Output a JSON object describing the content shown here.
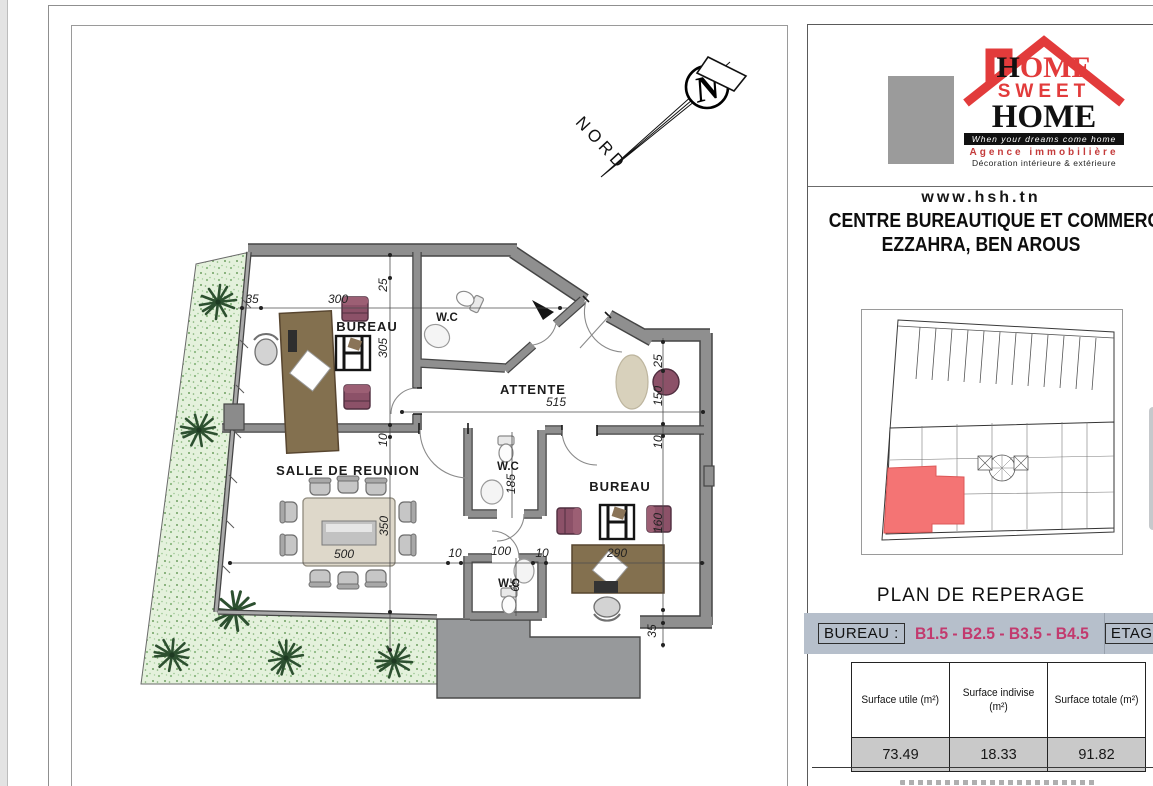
{
  "floor_plan": {
    "north_label": "NORD",
    "room_labels": [
      "BUREAU",
      "W.C",
      "ATTENTE",
      "SALLE DE REUNION",
      "W.C",
      "BUREAU",
      "W.C"
    ],
    "dims": [
      "35",
      "300",
      "25",
      "305",
      "10",
      "350",
      "500",
      "10",
      "100",
      "10",
      "515",
      "25",
      "150",
      "10",
      "160",
      "290",
      "185",
      "65",
      "35"
    ]
  },
  "panel": {
    "brand": {
      "word1": "HOME",
      "word2": "SWEET",
      "word3": "HOME",
      "tagline": "When your dreams come home",
      "agency_line1": "Agence immobilière",
      "agency_line2": "Décoration intérieure & extérieure"
    },
    "website": "www.hsh.tn",
    "title_line1": "CENTRE BUREAUTIQUE ET COMMERCIAL",
    "title_line2": "EZZAHRA, BEN AROUS",
    "reperage_title": "PLAN DE REPERAGE",
    "unit_bar": {
      "label": "BUREAU :",
      "units": "B1.5 - B2.5 - B3.5 - B4.5",
      "floor_label": "ETAGE"
    },
    "surface_table": {
      "headers": [
        "Surface utile (m²)",
        "Surface indivise (m²)",
        "Surface totale (m²)"
      ],
      "values": [
        "73.49",
        "18.33",
        "91.82"
      ]
    }
  },
  "colors": {
    "roof_red": "#e23b3b",
    "units_pink": "#c23a6e",
    "bar_bg": "#b6bfcb",
    "highlight_red": "#f47474"
  }
}
